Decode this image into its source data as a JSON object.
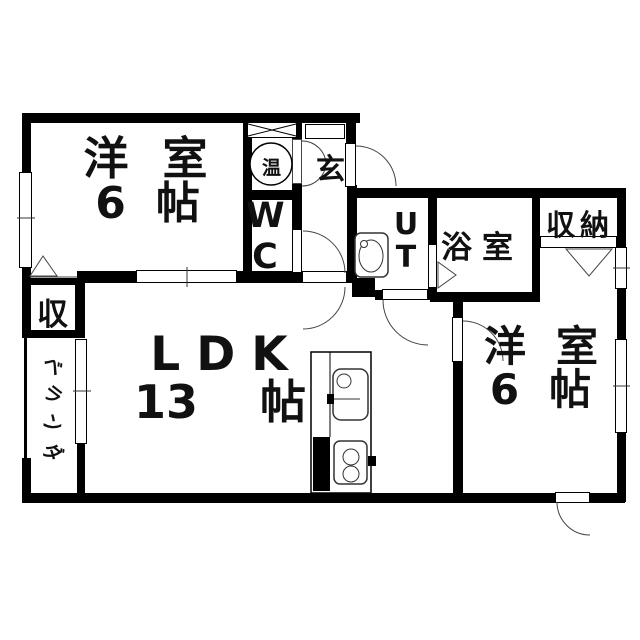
{
  "floorplan": {
    "rooms": {
      "bedroom_left": {
        "label": "洋室",
        "size_num": "6",
        "size_unit": "帖"
      },
      "bedroom_right": {
        "label": "洋室",
        "size_num": "6",
        "size_unit": "帖"
      },
      "ldk": {
        "label": "LDK",
        "size_num": "13",
        "size_unit": "帖"
      },
      "bathroom": {
        "label": "浴室"
      },
      "utility": {
        "label": "UT"
      },
      "wc": {
        "label": "WC"
      },
      "entrance": {
        "label": "玄"
      },
      "water_heater": {
        "label": "温"
      },
      "closet_right": {
        "label": "収納"
      },
      "closet_left": {
        "label": "収"
      },
      "veranda": {
        "label": "ベランダ"
      }
    },
    "colors": {
      "wall": "#000000",
      "line": "#333333",
      "text": "#111111",
      "background": "#ffffff"
    }
  }
}
